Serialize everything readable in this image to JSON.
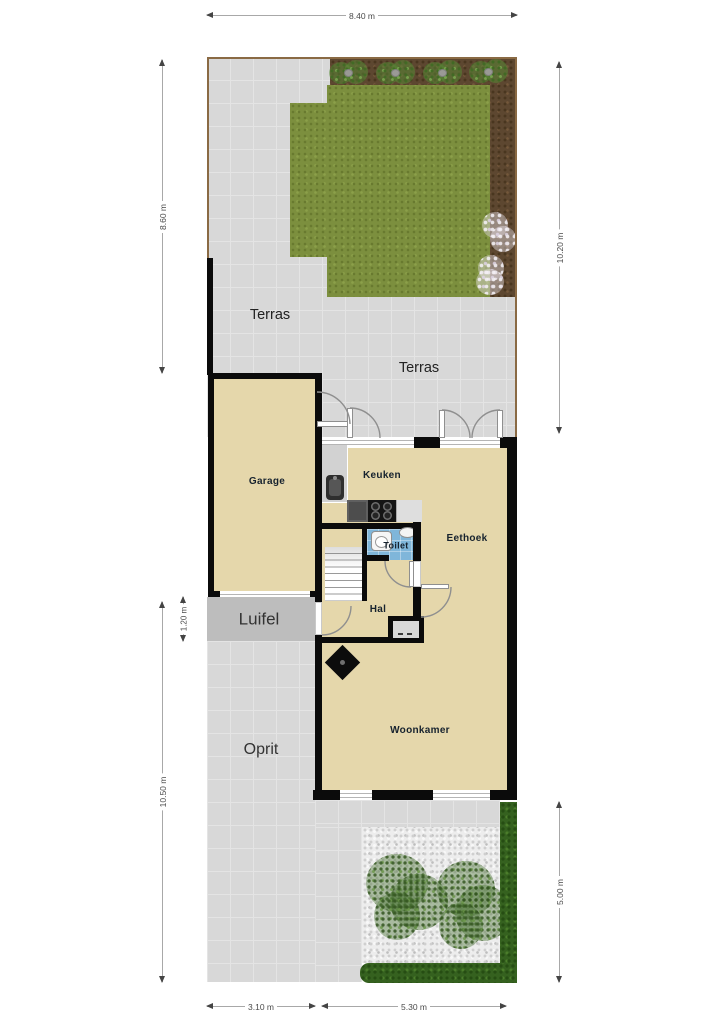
{
  "rooms": {
    "garage": "Garage",
    "keuken": "Keuken",
    "toilet": "Toilet",
    "eethoek": "Eethoek",
    "hal": "Hal",
    "woonkamer": "Woonkamer"
  },
  "outdoor": {
    "terras_upper": "Terras",
    "terras_lower": "Terras",
    "luifel": "Luifel",
    "oprit": "Oprit"
  },
  "dimensions": {
    "plot_width_top": "8.40 m",
    "garden_depth_left": "8.60 m",
    "garden_depth_right": "10.20 m",
    "luifel_depth": "1.20 m",
    "driveway_depth": "10.50 m",
    "backyard_depth": "5.00 m",
    "driveway_width": "3.10 m",
    "house_width": "5.30 m"
  },
  "colors": {
    "wall": "#0b0b0b",
    "floor": "#e5d7ab",
    "paving": "#d8d8d8",
    "paving_grid": "#e4e4e4",
    "canopy": "#bdbdbd",
    "grass": "#7c8f3e",
    "soil": "#5d4730",
    "toilet_floor": "#7fb6da",
    "hedge": "#35611f",
    "gravel": "#ededed",
    "tree": "#4a7132",
    "fence": "#8a6a44",
    "dim_line": "#a8a8a8",
    "dim_text": "#4a4a4a",
    "room_label": "#16222e",
    "area_label": "#222222"
  }
}
